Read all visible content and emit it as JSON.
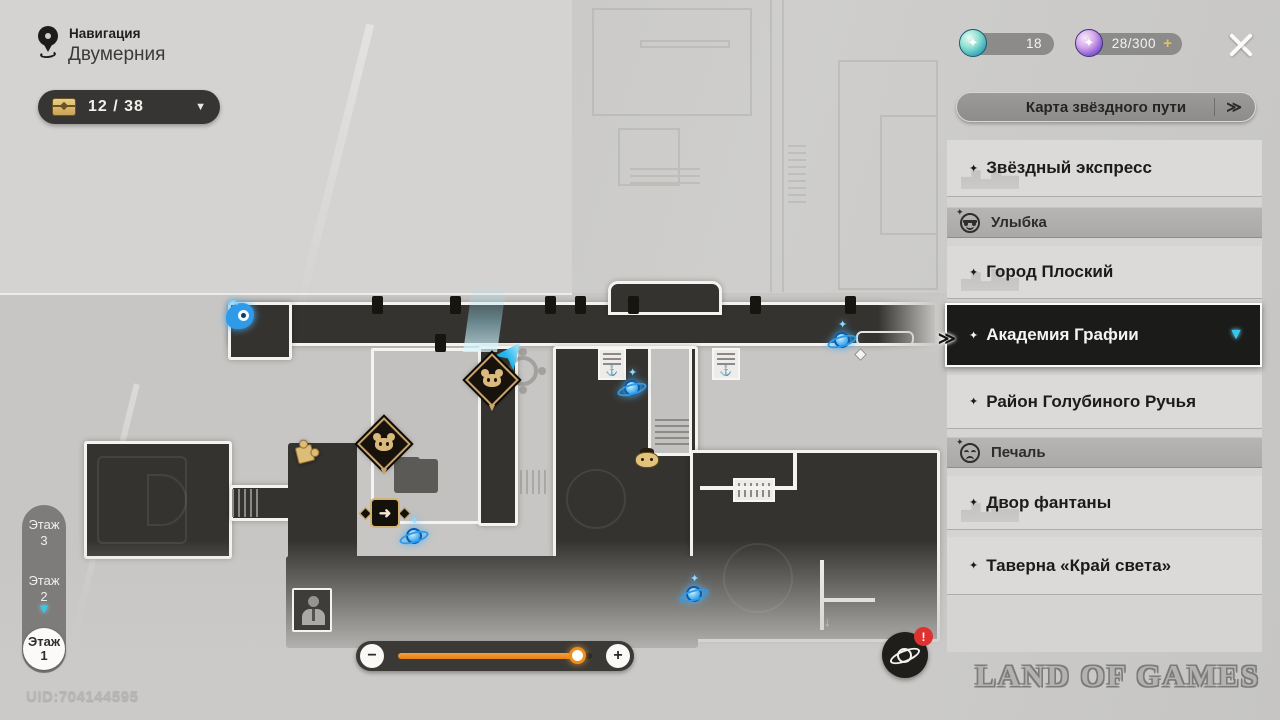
{
  "header": {
    "nav_label": "Навигация",
    "location_title": "Двумерния",
    "chest_counter": "12 / 38"
  },
  "currencies": {
    "items": [
      {
        "icon": "teal-jade-icon",
        "value": "18"
      },
      {
        "icon": "purple-pass-icon",
        "value": "28/300",
        "action": "+"
      }
    ]
  },
  "sidebar": {
    "map_button_label": "Карта звёздного пути",
    "map_button_chevron": "≫",
    "selected_pointer": "≫",
    "items": [
      {
        "type": "item",
        "label": "Звёздный экспресс"
      },
      {
        "type": "header",
        "label": "Улыбка",
        "icon": "smile-sunglasses-icon"
      },
      {
        "type": "item",
        "label": "Город Плоский"
      },
      {
        "type": "item",
        "label": "Академия Графии",
        "selected": true
      },
      {
        "type": "item",
        "label": "Район Голубиного Ручья"
      },
      {
        "type": "header",
        "label": "Печаль",
        "icon": "sad-face-icon"
      },
      {
        "type": "item",
        "label": "Двор фантаны"
      },
      {
        "type": "item",
        "label": "Таверна «Край света»"
      }
    ]
  },
  "floors": {
    "label": "Этаж",
    "levels": [
      "3",
      "2",
      "1"
    ],
    "active_level": "1"
  },
  "zoom_slider": {
    "decrease": "−",
    "increase": "+",
    "value_percent": 93
  },
  "footer": {
    "uid": "UID:704144595",
    "watermark": "LAND OF GAMES"
  },
  "icons": {
    "star_bullet": "✦",
    "dropdown_arrow": "▼",
    "selected_arrow": "▼",
    "anchor_glyph": "⚓",
    "exit_arrow": "➜",
    "notification": "!",
    "down_arrow": "↓",
    "sparkle": "✦"
  },
  "colors": {
    "accent_orange": "#EE8A1E",
    "accent_cyan": "#35C8EE",
    "marker_gold": "#C9A468",
    "teleport_blue": "#2E9AE8",
    "selected_bg": "#1B1B1A",
    "alert_red": "#E03131"
  }
}
